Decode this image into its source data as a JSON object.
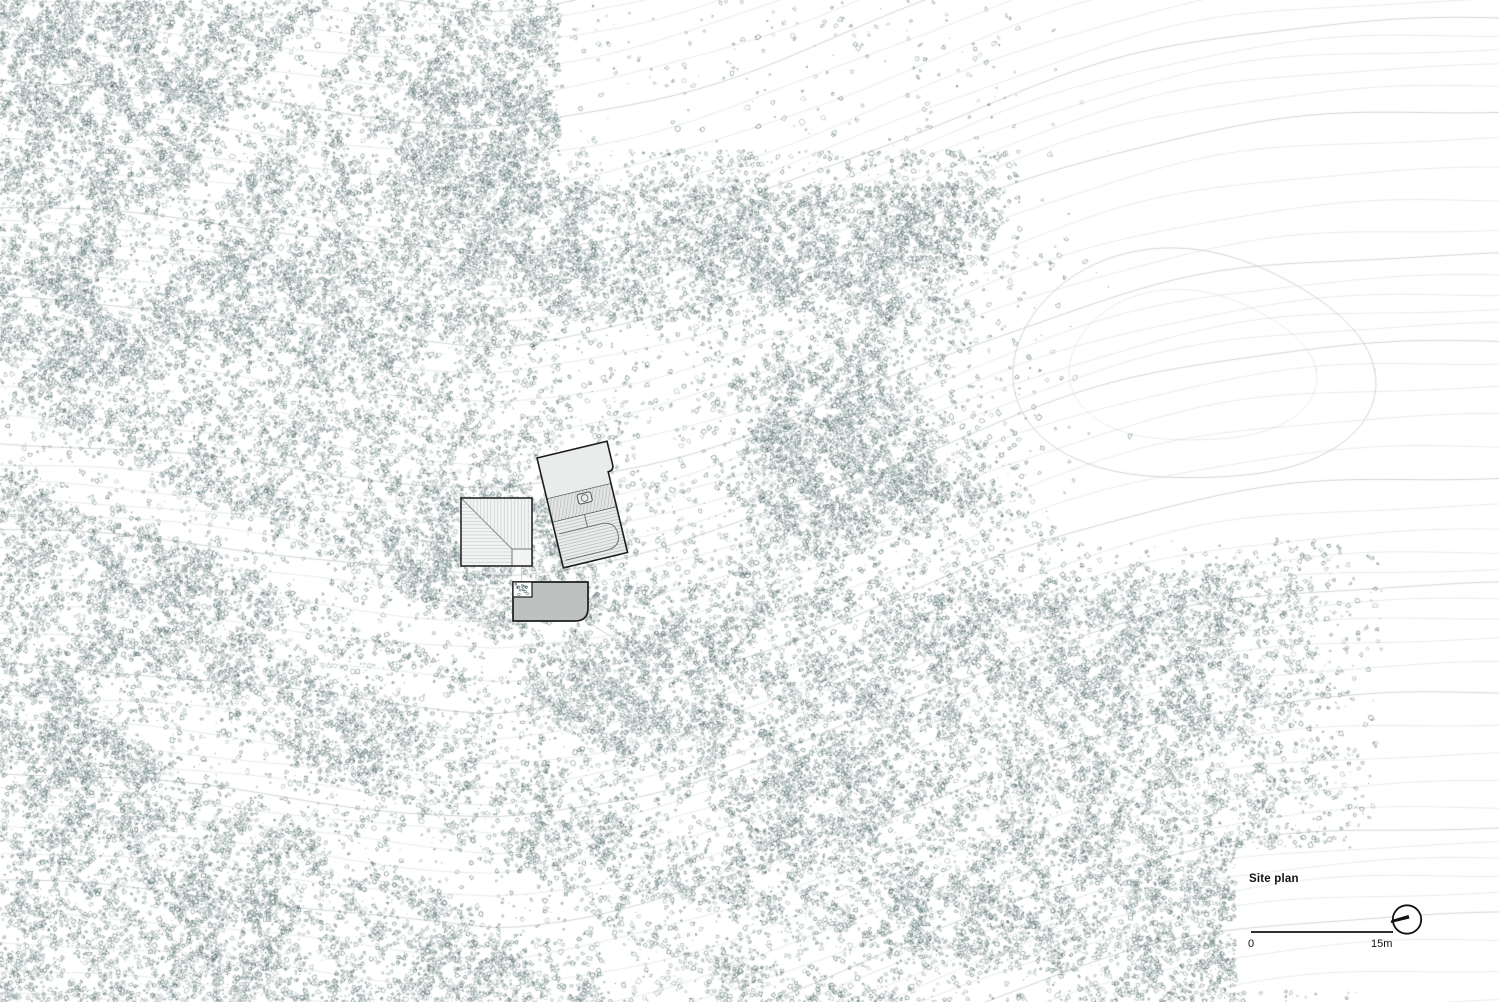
{
  "page": {
    "title": "Site plan"
  },
  "legend": {
    "title": "Site plan",
    "scale_start": "0",
    "scale_end": "15m"
  },
  "icons": {
    "north_arrow": "compass-circle-with-needle"
  },
  "colors": {
    "paper": "#ffffff",
    "contour": "#cdd3d2",
    "contour_index": "#bcc3c2",
    "vegetation": [
      "#5a7473",
      "#49615f",
      "#6e8886"
    ],
    "outline": "#1c1c1c",
    "building_pale": "#f3f4f4",
    "building_light": "#eaecec",
    "building_mid": "#e2e5e4",
    "building_dark": "#bdc2c1",
    "hatch": "#c7cccb",
    "hatch_dark": "#b2b7b6",
    "detail": "#666b6a",
    "faint_line": "#d6d9d8",
    "scalebar": "#2f2f2f",
    "text": "#111111"
  },
  "terrain": {
    "width": 1499,
    "height": 1002,
    "seed": 1337,
    "base": 0.78,
    "mark_line_width": 0.7,
    "contours": {
      "spacing": 23,
      "bmin": -340,
      "bmax": 1380,
      "amp1": 85,
      "wl1": 450,
      "ph1": 1.15,
      "amp2": 22,
      "wl2": 162,
      "ph2": 3.9,
      "bend": 500,
      "slope_l": 0.06,
      "slope_r": -0.085,
      "step": 22
    },
    "loops": [
      [
        1190,
        368,
        170,
        122,
        0.8
      ],
      [
        1190,
        368,
        116,
        80,
        0.35
      ]
    ],
    "clears": [
      [
        1190,
        365,
        300,
        235,
        0.02
      ],
      [
        608,
        400,
        115,
        95,
        0.3
      ],
      [
        690,
        510,
        85,
        125,
        0.3
      ],
      [
        1100,
        470,
        90,
        60,
        0.3
      ]
    ],
    "corridors": [
      [
        0,
        430,
        500,
        665,
        26,
        0.15
      ],
      [
        120,
        700,
        683,
        990,
        32,
        0.2
      ],
      [
        300,
        640,
        700,
        820,
        24,
        0.35
      ],
      [
        350,
        0,
        120,
        300,
        26,
        0.25
      ],
      [
        660,
        920,
        1060,
        1002,
        24,
        0.3
      ],
      [
        900,
        560,
        1250,
        535,
        30,
        0.3
      ],
      [
        580,
        350,
        780,
        330,
        28,
        0.4
      ]
    ],
    "boosts": [
      [
        850,
        465,
        120,
        95,
        2.6
      ],
      [
        760,
        250,
        90,
        70,
        1.7
      ],
      [
        900,
        255,
        95,
        60,
        1.7
      ],
      [
        480,
        130,
        110,
        100,
        1.9
      ],
      [
        540,
        235,
        80,
        80,
        1.7
      ],
      [
        180,
        115,
        175,
        120,
        1.6
      ],
      [
        80,
        300,
        100,
        90,
        1.6
      ],
      [
        255,
        305,
        110,
        80,
        1.5
      ],
      [
        160,
        520,
        140,
        100,
        1.5
      ],
      [
        90,
        740,
        120,
        100,
        1.5
      ],
      [
        185,
        900,
        145,
        90,
        1.5
      ],
      [
        420,
        560,
        90,
        70,
        1.5
      ],
      [
        60,
        60,
        130,
        95,
        1.7
      ],
      [
        640,
        700,
        120,
        80,
        1.4
      ],
      [
        800,
        800,
        120,
        80,
        1.4
      ],
      [
        600,
        950,
        120,
        60,
        1.4
      ],
      [
        900,
        920,
        110,
        60,
        1.3
      ],
      [
        1080,
        640,
        110,
        70,
        1.3
      ],
      [
        1200,
        700,
        90,
        60,
        1.25
      ],
      [
        1120,
        860,
        100,
        60,
        1.2
      ],
      [
        1060,
        555,
        85,
        50,
        1.25
      ],
      [
        1255,
        605,
        80,
        50,
        1.2
      ],
      [
        950,
        470,
        60,
        55,
        1.4
      ],
      [
        420,
        905,
        80,
        60,
        1.3
      ],
      [
        320,
        800,
        85,
        70,
        1.35
      ],
      [
        545,
        520,
        14,
        42,
        3.2
      ],
      [
        552,
        562,
        18,
        26,
        2.8
      ],
      [
        562,
        592,
        24,
        14,
        2.2
      ],
      [
        536,
        612,
        16,
        10,
        1.8
      ]
    ],
    "exclusion_rect": [
      1235,
      848,
      1500,
      990
    ],
    "court_speckles": {
      "x": 515.5,
      "y": 584,
      "w": 14,
      "h": 11,
      "count": 14
    }
  }
}
